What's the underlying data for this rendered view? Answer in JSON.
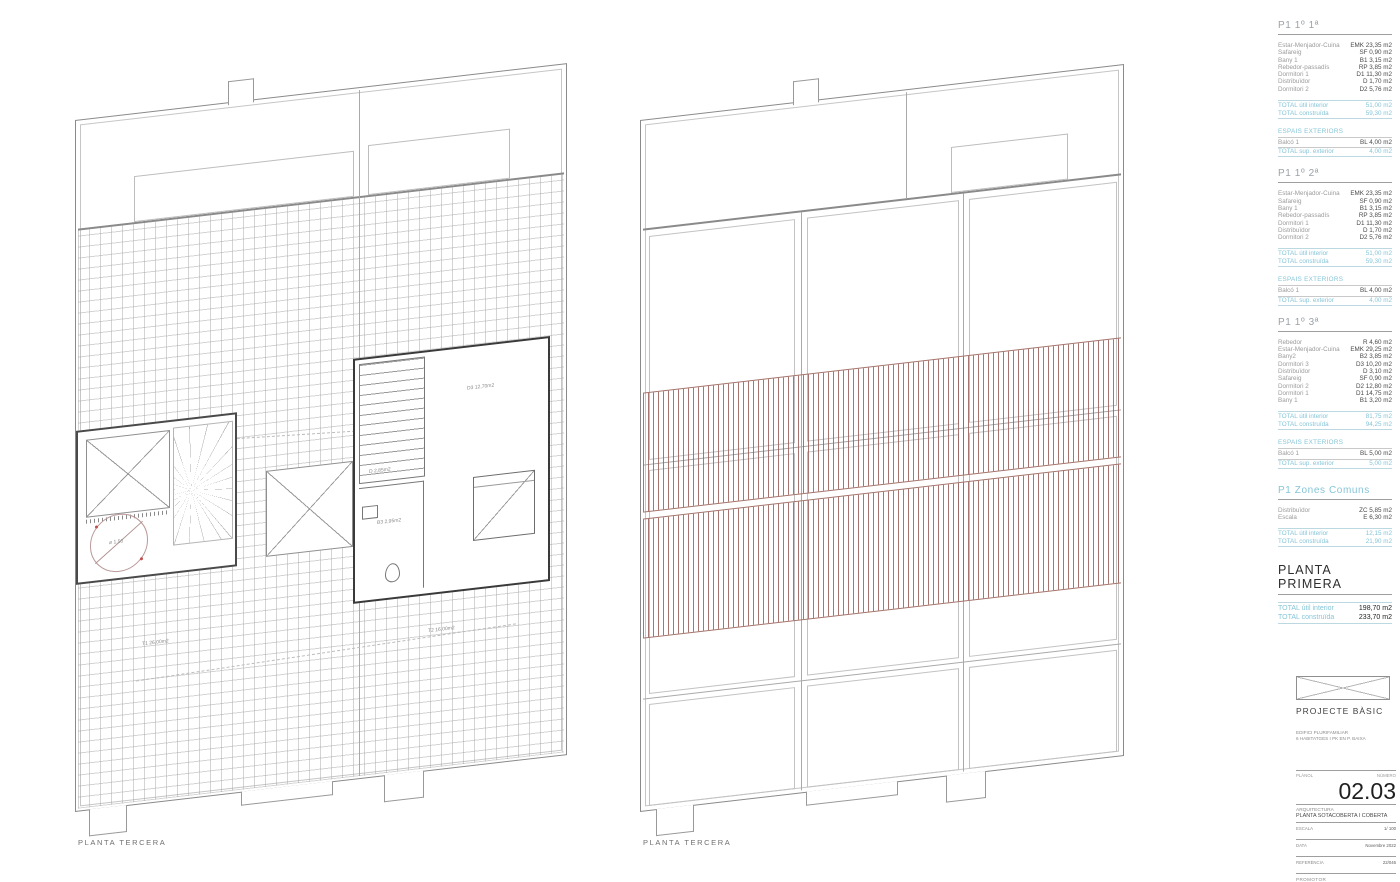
{
  "accent": "#85c5d8",
  "hatch_color": "#985c56",
  "plans": {
    "left": {
      "caption": "PLANTA TERCERA",
      "labels": {
        "circle": "ø 1,50",
        "room_d3": "D3 12,70m2",
        "distributor": "D 2,85m2",
        "bath": "B3 2,95m2",
        "terrace1": "T1 26,00m2",
        "terrace2": "T2 16,00m2"
      }
    },
    "right": {
      "caption": "PLANTA TERCERA"
    }
  },
  "sidebar": {
    "units": [
      {
        "heading": "P1 1º 1ª",
        "rows": [
          {
            "label": "Estar-Menjador-Cuina",
            "value": "EMK 23,35 m2"
          },
          {
            "label": "Safareig",
            "value": "SF 0,90 m2"
          },
          {
            "label": "Bany 1",
            "value": "B1 3,15 m2"
          },
          {
            "label": "Rebedor-passadís",
            "value": "RP 3,85 m2"
          },
          {
            "label": "Dormitori 1",
            "value": "D1 11,30 m2"
          },
          {
            "label": "Distribuïdor",
            "value": "D 1,70 m2"
          },
          {
            "label": "Dormitori 2",
            "value": "D2 5,76 m2"
          }
        ],
        "totals": [
          {
            "label": "TOTAL útil interior",
            "value": "51,00 m2"
          },
          {
            "label": "TOTAL construïda",
            "value": "59,30 m2"
          }
        ],
        "exterior_heading": "ESPAIS EXTERIORS",
        "exterior_rows": [
          {
            "label": "Balcó 1",
            "value": "BL 4,00 m2"
          }
        ],
        "exterior_total": {
          "label": "TOTAL sup. exterior",
          "value": "4,00 m2"
        }
      },
      {
        "heading": "P1 1º 2ª",
        "rows": [
          {
            "label": "Estar-Menjador-Cuina",
            "value": "EMK 23,35 m2"
          },
          {
            "label": "Safareig",
            "value": "SF 0,90 m2"
          },
          {
            "label": "Bany 1",
            "value": "B1 3,15 m2"
          },
          {
            "label": "Rebedor-passadís",
            "value": "RP 3,85 m2"
          },
          {
            "label": "Dormitori 1",
            "value": "D1 11,30 m2"
          },
          {
            "label": "Distribuïdor",
            "value": "D 1,70 m2"
          },
          {
            "label": "Dormitori 2",
            "value": "D2 5,76 m2"
          }
        ],
        "totals": [
          {
            "label": "TOTAL útil interior",
            "value": "51,00 m2"
          },
          {
            "label": "TOTAL construïda",
            "value": "59,30 m2"
          }
        ],
        "exterior_heading": "ESPAIS EXTERIORS",
        "exterior_rows": [
          {
            "label": "Balcó 1",
            "value": "BL 4,00 m2"
          }
        ],
        "exterior_total": {
          "label": "TOTAL sup. exterior",
          "value": "4,00 m2"
        }
      },
      {
        "heading": "P1 1º 3ª",
        "rows": [
          {
            "label": "Rebedor",
            "value": "R 4,60 m2"
          },
          {
            "label": "Estar-Menjador-Cuina",
            "value": "EMK 29,25 m2"
          },
          {
            "label": "Bany2",
            "value": "B2 3,85 m2"
          },
          {
            "label": "Dormitori 3",
            "value": "D3 10,20 m2"
          },
          {
            "label": "Distribuïdor",
            "value": "D 3,10 m2"
          },
          {
            "label": "Safareig",
            "value": "SF 0,90 m2"
          },
          {
            "label": "Dormitori 2",
            "value": "D2 12,80 m2"
          },
          {
            "label": "Dormitori 1",
            "value": "D1 14,75 m2"
          },
          {
            "label": "Bany 1",
            "value": "B1 3,20 m2"
          }
        ],
        "totals": [
          {
            "label": "TOTAL útil interior",
            "value": "81,75 m2"
          },
          {
            "label": "TOTAL construïda",
            "value": "94,25 m2"
          }
        ],
        "exterior_heading": "ESPAIS EXTERIORS",
        "exterior_rows": [
          {
            "label": "Balcó 1",
            "value": "BL 5,00 m2"
          }
        ],
        "exterior_total": {
          "label": "TOTAL sup. exterior",
          "value": "5,00 m2"
        }
      }
    ],
    "common": {
      "heading": "P1  Zones Comuns",
      "rows": [
        {
          "label": "Distribuïdor",
          "value": "ZC 5,85 m2"
        },
        {
          "label": "Escala",
          "value": "E 6,30 m2"
        }
      ],
      "totals": [
        {
          "label": "TOTAL útil interior",
          "value": "12,15 m2"
        },
        {
          "label": "TOTAL construïda",
          "value": "21,90 m2"
        }
      ]
    },
    "floor": {
      "heading": "PLANTA PRIMERA",
      "totals": [
        {
          "label": "TOTAL útil interior",
          "value": "198,70 m2"
        },
        {
          "label": "TOTAL construïda",
          "value": "233,70 m2"
        }
      ]
    }
  },
  "titleblock": {
    "project_type": "PROJECTE BÀSIC",
    "line1": "EDIFICI PLURIFAMILIAR",
    "line2": "6 HABITATGES I PK EN P. BAIXA",
    "planol_label": "PLÀNOL",
    "numero_label": "NÚMERO",
    "number": "02.03",
    "discipline": "ARQUITECTURA",
    "sheet_title": "PLANTA SOTACOBERTA I COBERTA",
    "escala_label": "ESCALA",
    "escala_value": "1/ 100",
    "data_label": "DATA",
    "data_value": "Novembre 2022",
    "ref_label": "REFERÈNCIA",
    "ref_value": "22/046",
    "promotor_label": "PROMOTOR"
  }
}
